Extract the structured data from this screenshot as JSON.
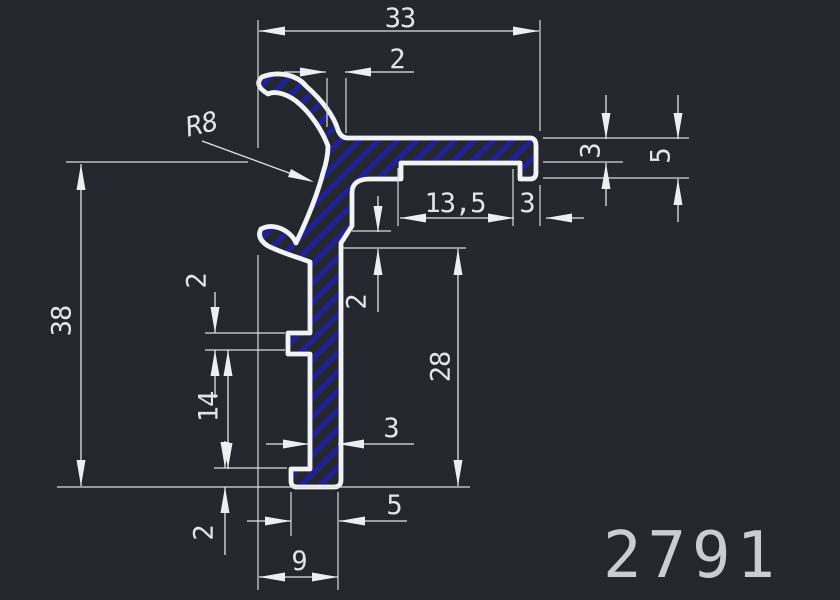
{
  "part_number": "2791",
  "colors": {
    "background": "#24282e",
    "dimension_line": "#e2e5e8",
    "profile_stroke": "#f1f3f5",
    "hatch_blue": "#20209a",
    "part_number_color": "#c8cdd3"
  },
  "dimensions": {
    "total_width": "33",
    "hook_wall": "2",
    "hook_radius": "R8",
    "recess_width": "13,5",
    "right_foot_width": "3",
    "arm_thickness": "3",
    "arm_end_height": "5",
    "total_height": "38",
    "notch_height": "2",
    "notch_to_foot": "14",
    "stem_step": "2",
    "stem_height": "28",
    "stem_thickness": "3",
    "foot_width": "5",
    "foot_height": "2",
    "bottom_width": "9"
  }
}
